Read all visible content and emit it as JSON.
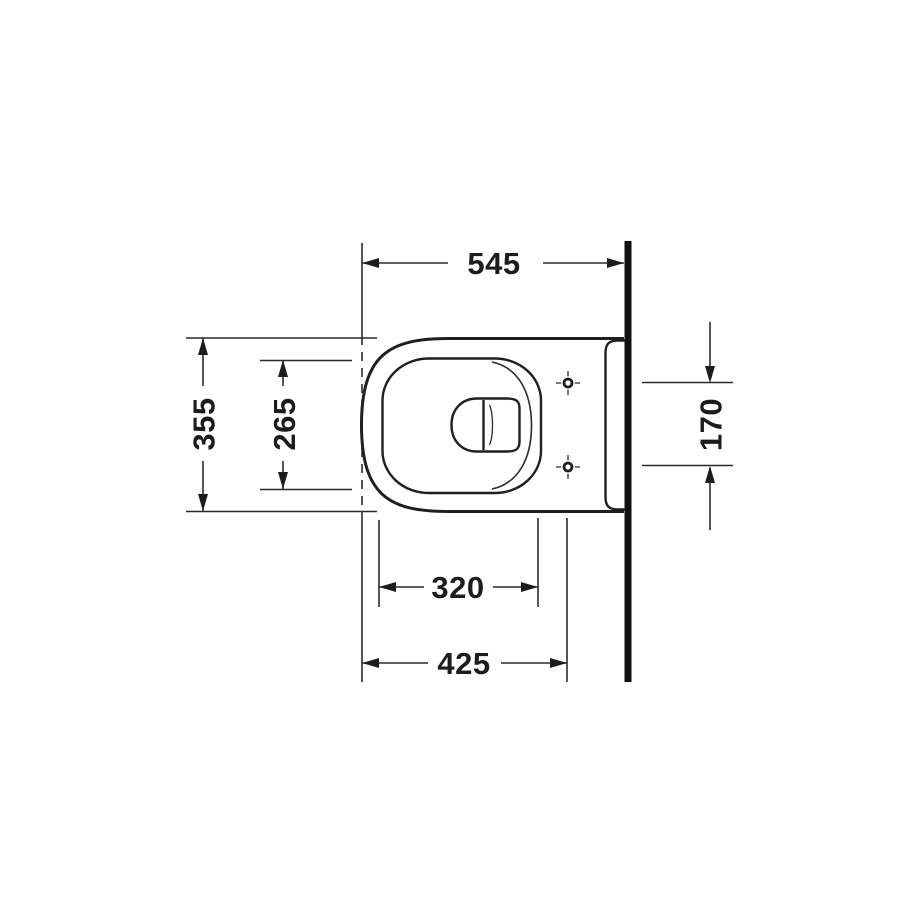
{
  "drawing": {
    "subject": "Wall-mounted toilet plan-view technical dimension drawing",
    "units": "mm",
    "line_color": "#1f1f1f",
    "background_color": "#ffffff",
    "labels": {
      "top": "545",
      "left_outer": "355",
      "left_inner": "265",
      "right": "170",
      "bottom_inner": "320",
      "bottom_outer": "425"
    },
    "measurement_values": [
      545,
      355,
      265,
      170,
      320,
      425
    ]
  }
}
